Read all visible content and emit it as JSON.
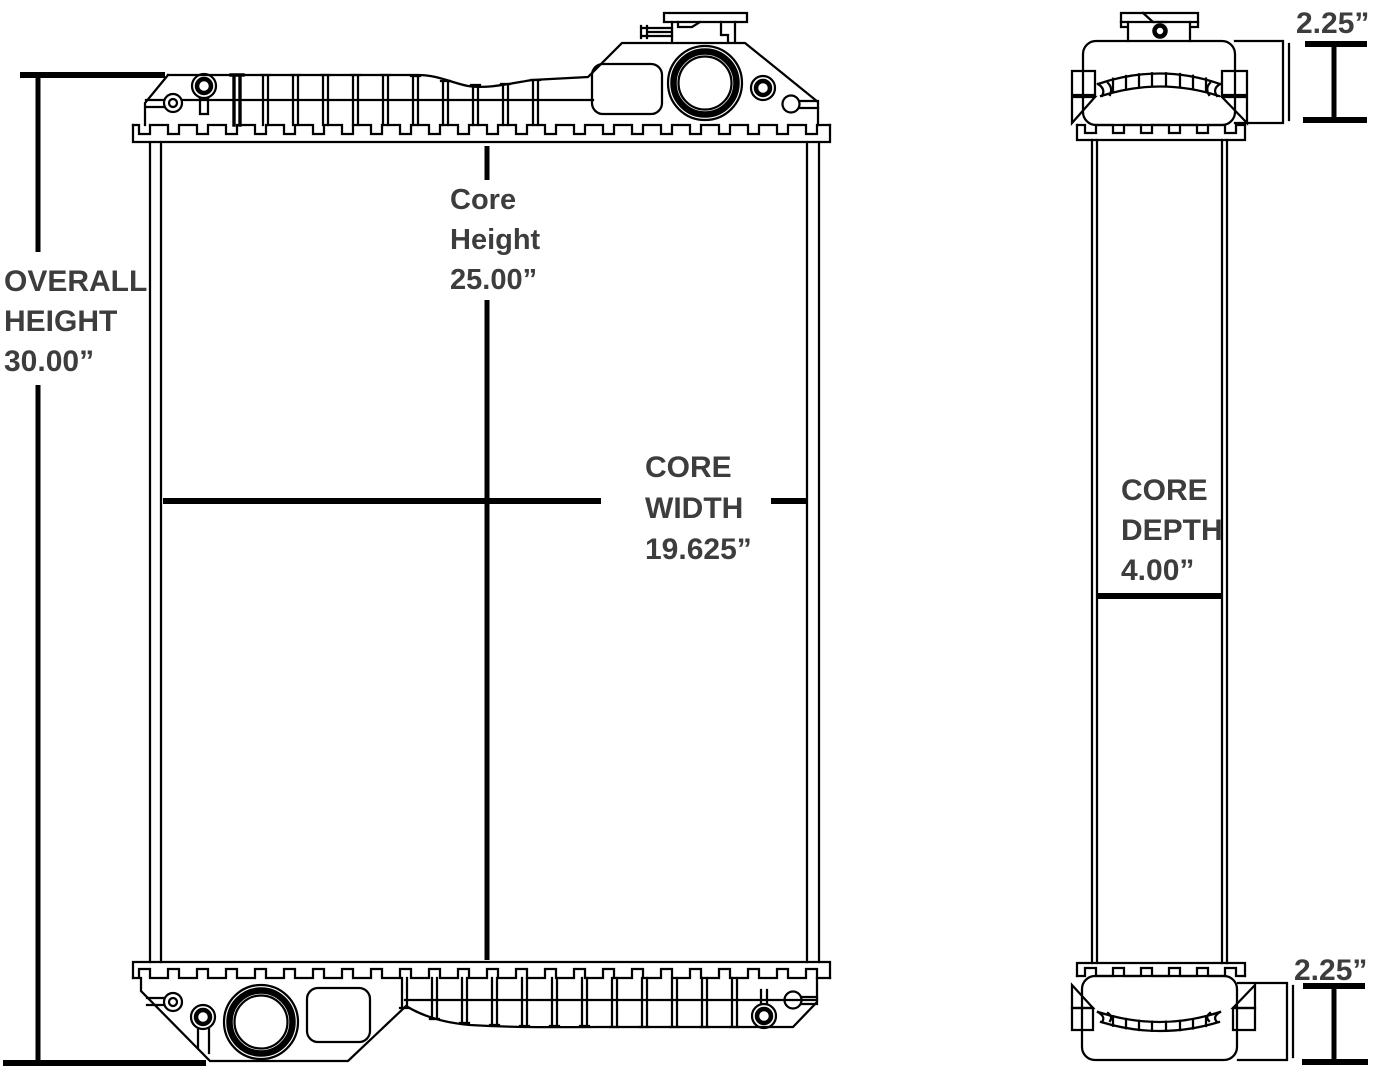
{
  "diagram": {
    "background_color": "#ffffff",
    "line_color": "#000000",
    "label_color": "#3d3d3d",
    "dimensions": {
      "overall_height": {
        "lines": [
          "OVERALL",
          "HEIGHT",
          "30.00”"
        ]
      },
      "core_height": {
        "lines": [
          "Core",
          "Height",
          "25.00”"
        ]
      },
      "core_width": {
        "lines": [
          "CORE",
          "WIDTH",
          "19.625”"
        ]
      },
      "core_depth": {
        "lines": [
          "CORE",
          "DEPTH",
          "4.00”"
        ]
      },
      "top_outlet_diameter": {
        "label": "2.25”"
      },
      "bottom_outlet_diameter": {
        "label": "2.25”"
      }
    }
  }
}
